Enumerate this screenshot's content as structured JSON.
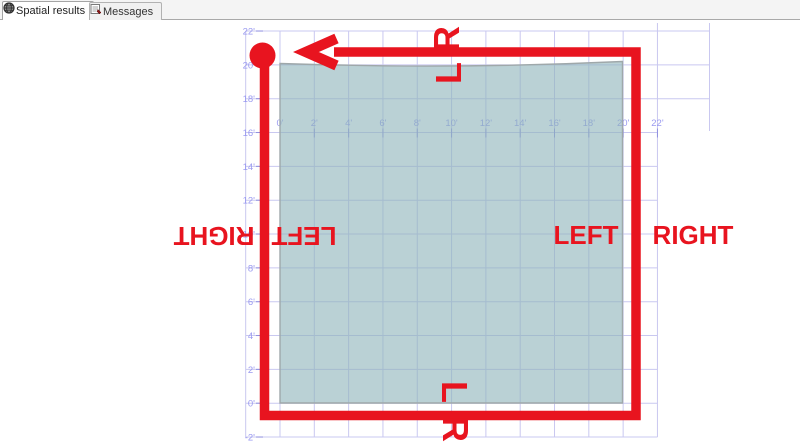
{
  "tabs": {
    "items": [
      {
        "label": "Spatial results",
        "active": true,
        "icon": "globe-icon"
      },
      {
        "label": "Messages",
        "active": false,
        "icon": "messages-icon"
      }
    ]
  },
  "chart_data": {
    "type": "spatial-grid",
    "x_axis": {
      "labels": [
        "0'",
        "2'",
        "4'",
        "6'",
        "8'",
        "10'",
        "12'",
        "14'",
        "16'",
        "18'",
        "20'",
        "22'"
      ],
      "values": [
        0,
        2,
        4,
        6,
        8,
        10,
        12,
        14,
        16,
        18,
        20,
        22
      ]
    },
    "y_axis": {
      "labels": [
        "22'",
        "20'",
        "18'",
        "16'",
        "14'",
        "12'",
        "10'",
        "8'",
        "6'",
        "4'",
        "2'",
        "0'",
        "-2'"
      ],
      "values": [
        22,
        20,
        18,
        16,
        14,
        12,
        10,
        8,
        6,
        4,
        2,
        0,
        -2
      ]
    },
    "polygon": {
      "approx_bounds_feet": {
        "x": [
          0,
          20
        ],
        "y": [
          0,
          20
        ]
      }
    },
    "ring": {
      "arrow_direction": "left",
      "start_marker": "circle-top-left"
    },
    "annotations": {
      "top_outside": "R",
      "top_inside": "L",
      "bottom_inside": "L",
      "bottom_outside": "R",
      "left_outside": "RIGHT",
      "left_inside": "LEFT",
      "right_inside": "LEFT",
      "right_outside": "RIGHT"
    },
    "colors": {
      "red": "#e8141f",
      "grid": "#c9c8f0",
      "axis_label": "#9a9af0",
      "tick": "#8f8fe0",
      "polygon_fill": "#b7d3d7",
      "polygon_fill_rgba": "rgba(143,180,187,0.62)",
      "polygon_stroke": "#9fa8aa"
    }
  }
}
